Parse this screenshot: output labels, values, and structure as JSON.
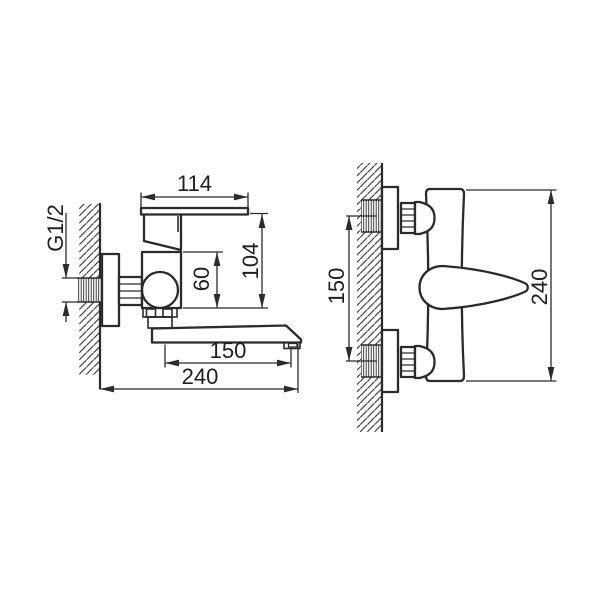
{
  "diagram": {
    "side_view": {
      "dims": {
        "handle_length": "114",
        "height": "104",
        "body_height": "60",
        "thread_size": "G1/2",
        "spout_reach": "150",
        "total_reach": "240"
      }
    },
    "front_view": {
      "dims": {
        "connection_spacing": "150",
        "overall_height": "240"
      }
    },
    "colors": {
      "line": "#2b2b2b",
      "background": "#ffffff"
    }
  }
}
